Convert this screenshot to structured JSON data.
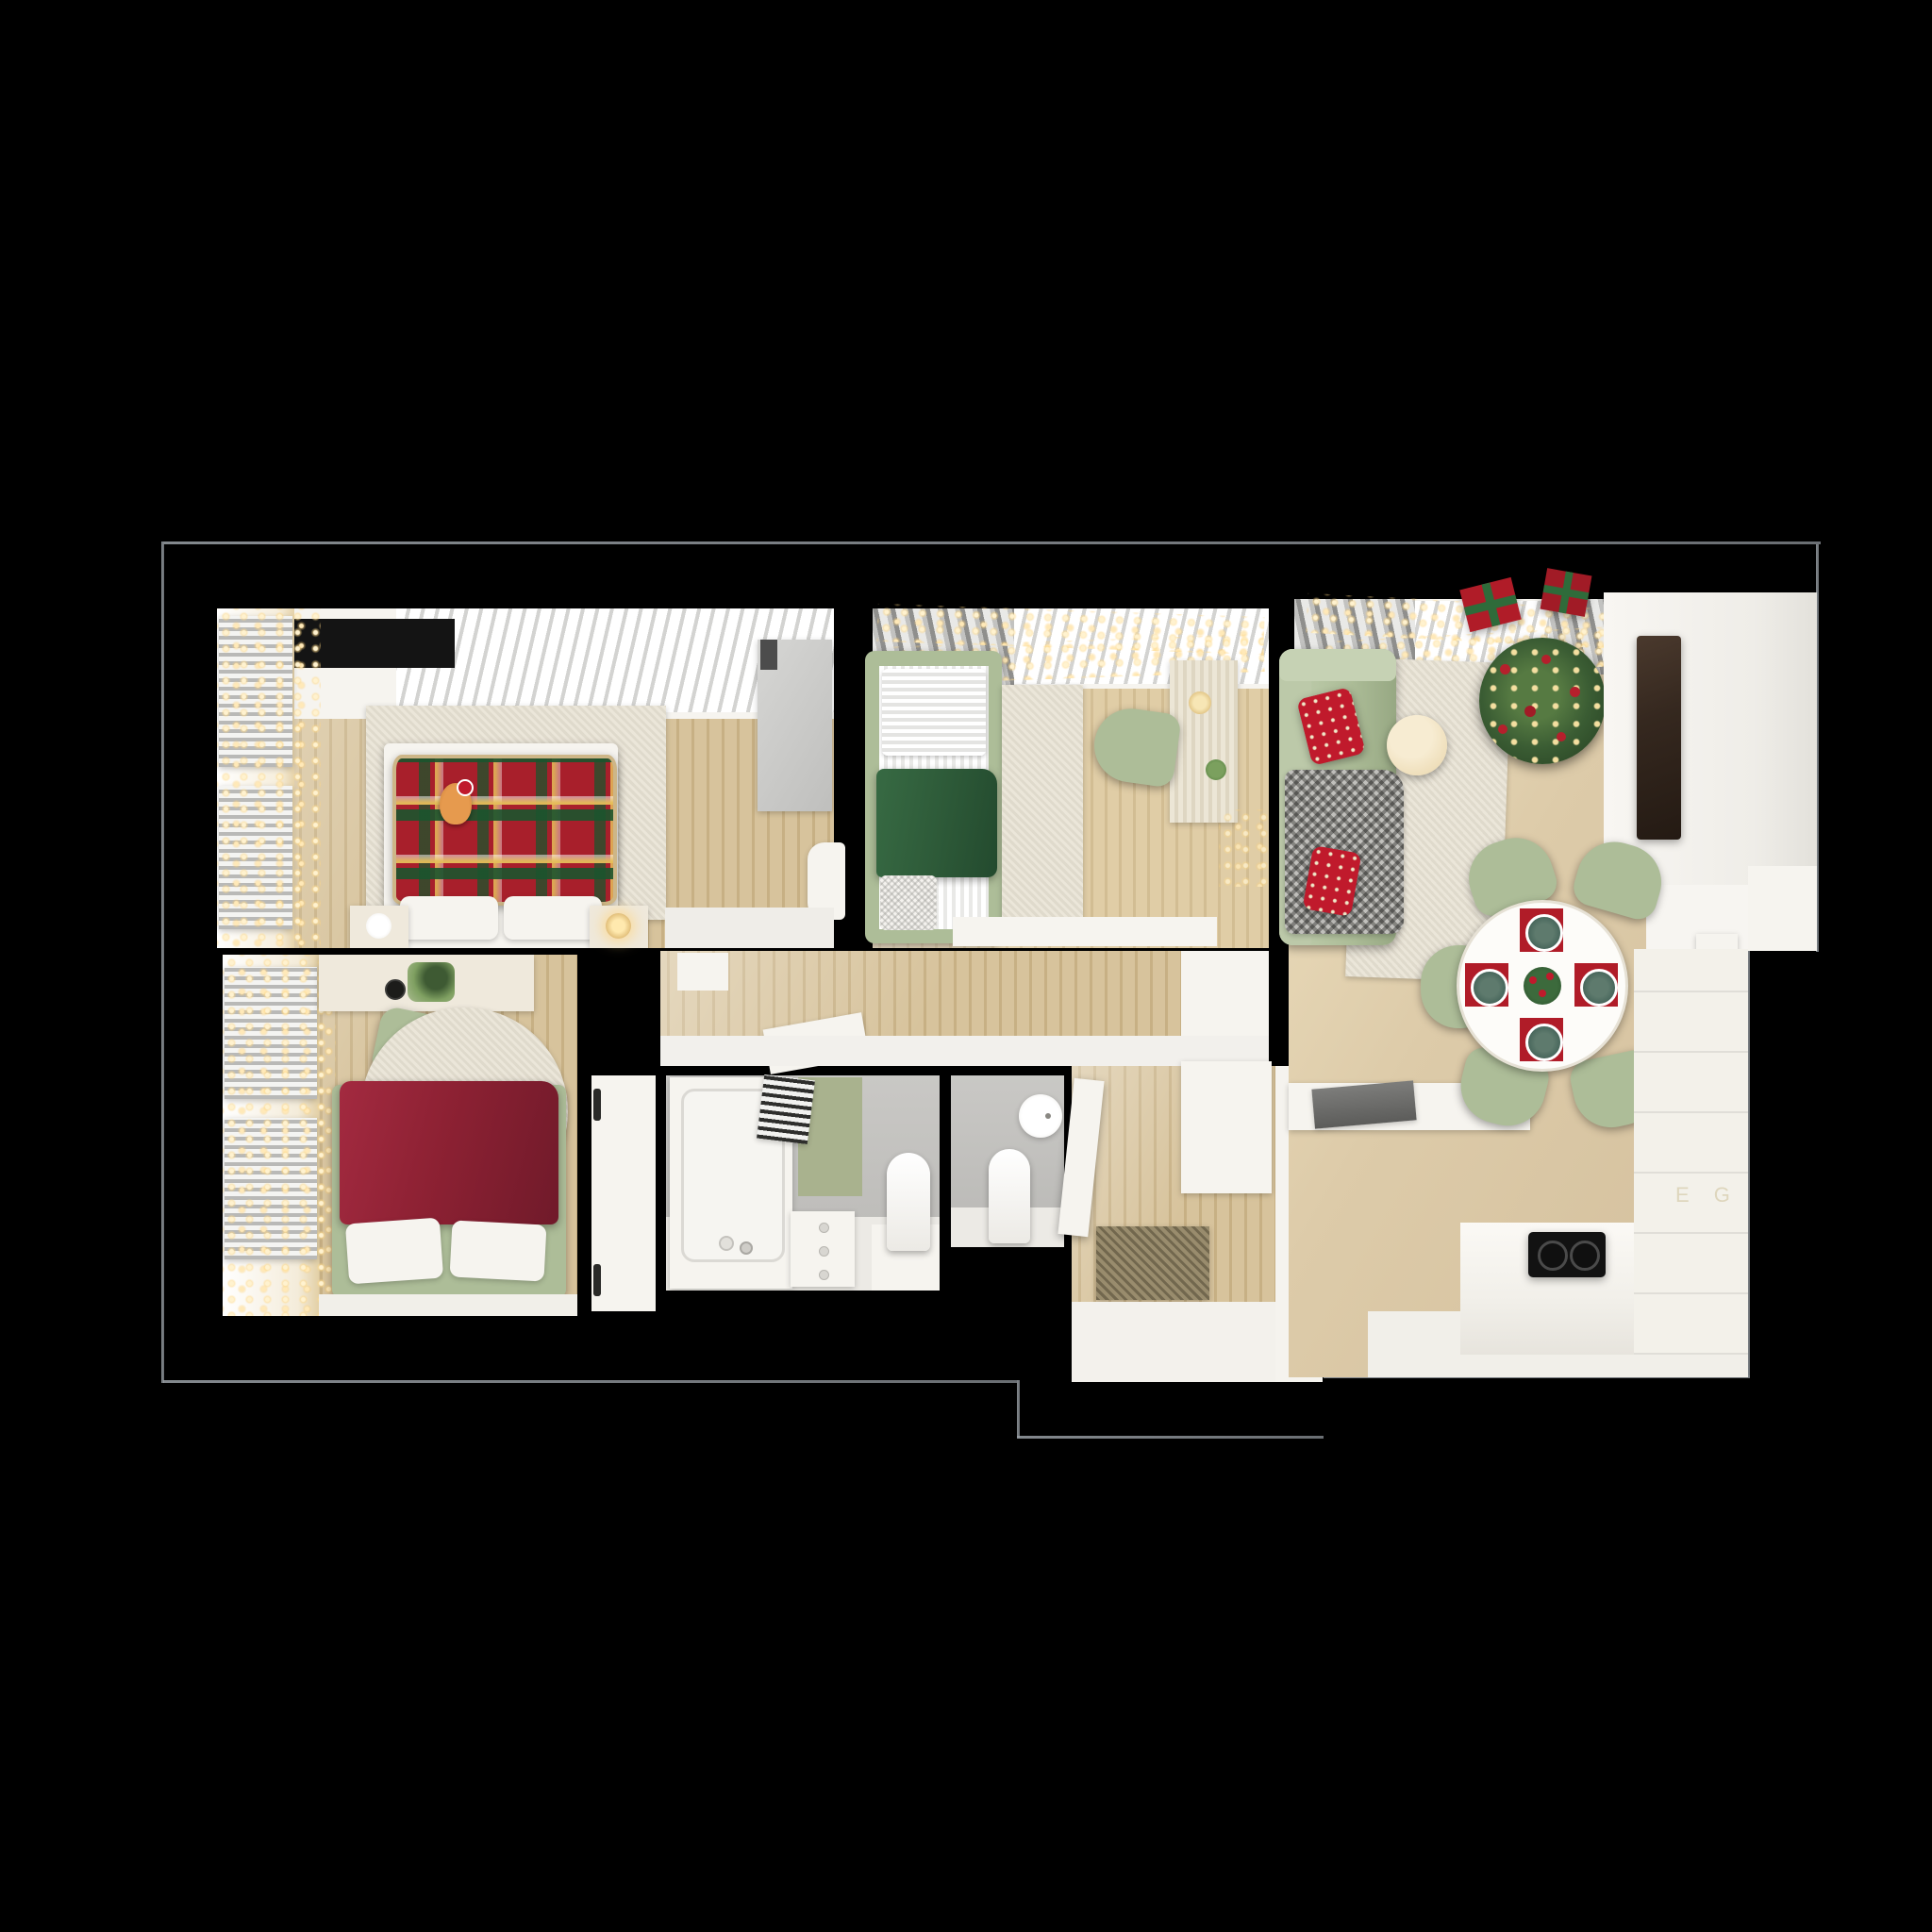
{
  "image": {
    "kind": "photorealistic top-down 3D floor plan render",
    "theme": "two-bedroom apartment decorated for Christmas",
    "background_color": "#000000"
  },
  "kitchen": {
    "cabinet_logo": "E G"
  },
  "palette": {
    "wood": "#d7c39c",
    "wood_dark": "#c7b084",
    "beige_floor": "#ddcba9",
    "rug": "#ebe6d9",
    "sage": "#adbd98",
    "green_blanket": "#2e5b39",
    "tartan_red": "#a81f2b",
    "burgundy": "#8d2133",
    "pillow_red": "#c01a2c",
    "gold_light": "#ffdf9e",
    "tree_green": "#3a5c33",
    "tv_brown": "#35281f",
    "bath_wall": "#c6c5c2",
    "mat_green": "#a9b28e",
    "doormat": "#998c6d",
    "wall_face": "#f5f3ee",
    "cooktop": "#121212"
  },
  "rooms": [
    {
      "name": "master-bedroom",
      "furniture": [
        "double-bed-tartan-plaid",
        "cat-with-santa-hat",
        "nightstand-lamp-left",
        "nightstand-lamp-right",
        "area-rug",
        "wardrobe",
        "armchair",
        "window-blinds-string-lights",
        "ceiling-panel"
      ]
    },
    {
      "name": "kids-bedroom",
      "furniture": [
        "single-bed-green",
        "runner-rug",
        "desk",
        "desk-chair",
        "candle",
        "string-lights"
      ]
    },
    {
      "name": "bedroom-2",
      "furniture": [
        "bed-burgundy-blanket",
        "round-rug",
        "desk",
        "desk-chair",
        "open-door",
        "window-blinds-string-lights"
      ]
    },
    {
      "name": "hallway",
      "furniture": [
        "leaning-board"
      ]
    },
    {
      "name": "bathroom",
      "furniture": [
        "bathtub",
        "green-mat",
        "striped-towel",
        "drawer-unit",
        "toilet"
      ]
    },
    {
      "name": "wc",
      "furniture": [
        "toilet",
        "round-sink"
      ]
    },
    {
      "name": "entry-hall",
      "furniture": [
        "doormat",
        "open-door",
        "cabinet"
      ]
    },
    {
      "name": "living-dining-kitchen",
      "furniture": [
        "sofa-green",
        "red-star-pillows",
        "gray-herringbone-blanket",
        "coffee-table",
        "christmas-tree",
        "gift-boxes",
        "tv",
        "tv-wall-unit",
        "dining-table-set-for-four",
        "dining-chairs",
        "console-table",
        "kitchen-counter",
        "induction-cooktop",
        "tall-cabinet-fridge",
        "string-lights",
        "curtains"
      ]
    }
  ]
}
